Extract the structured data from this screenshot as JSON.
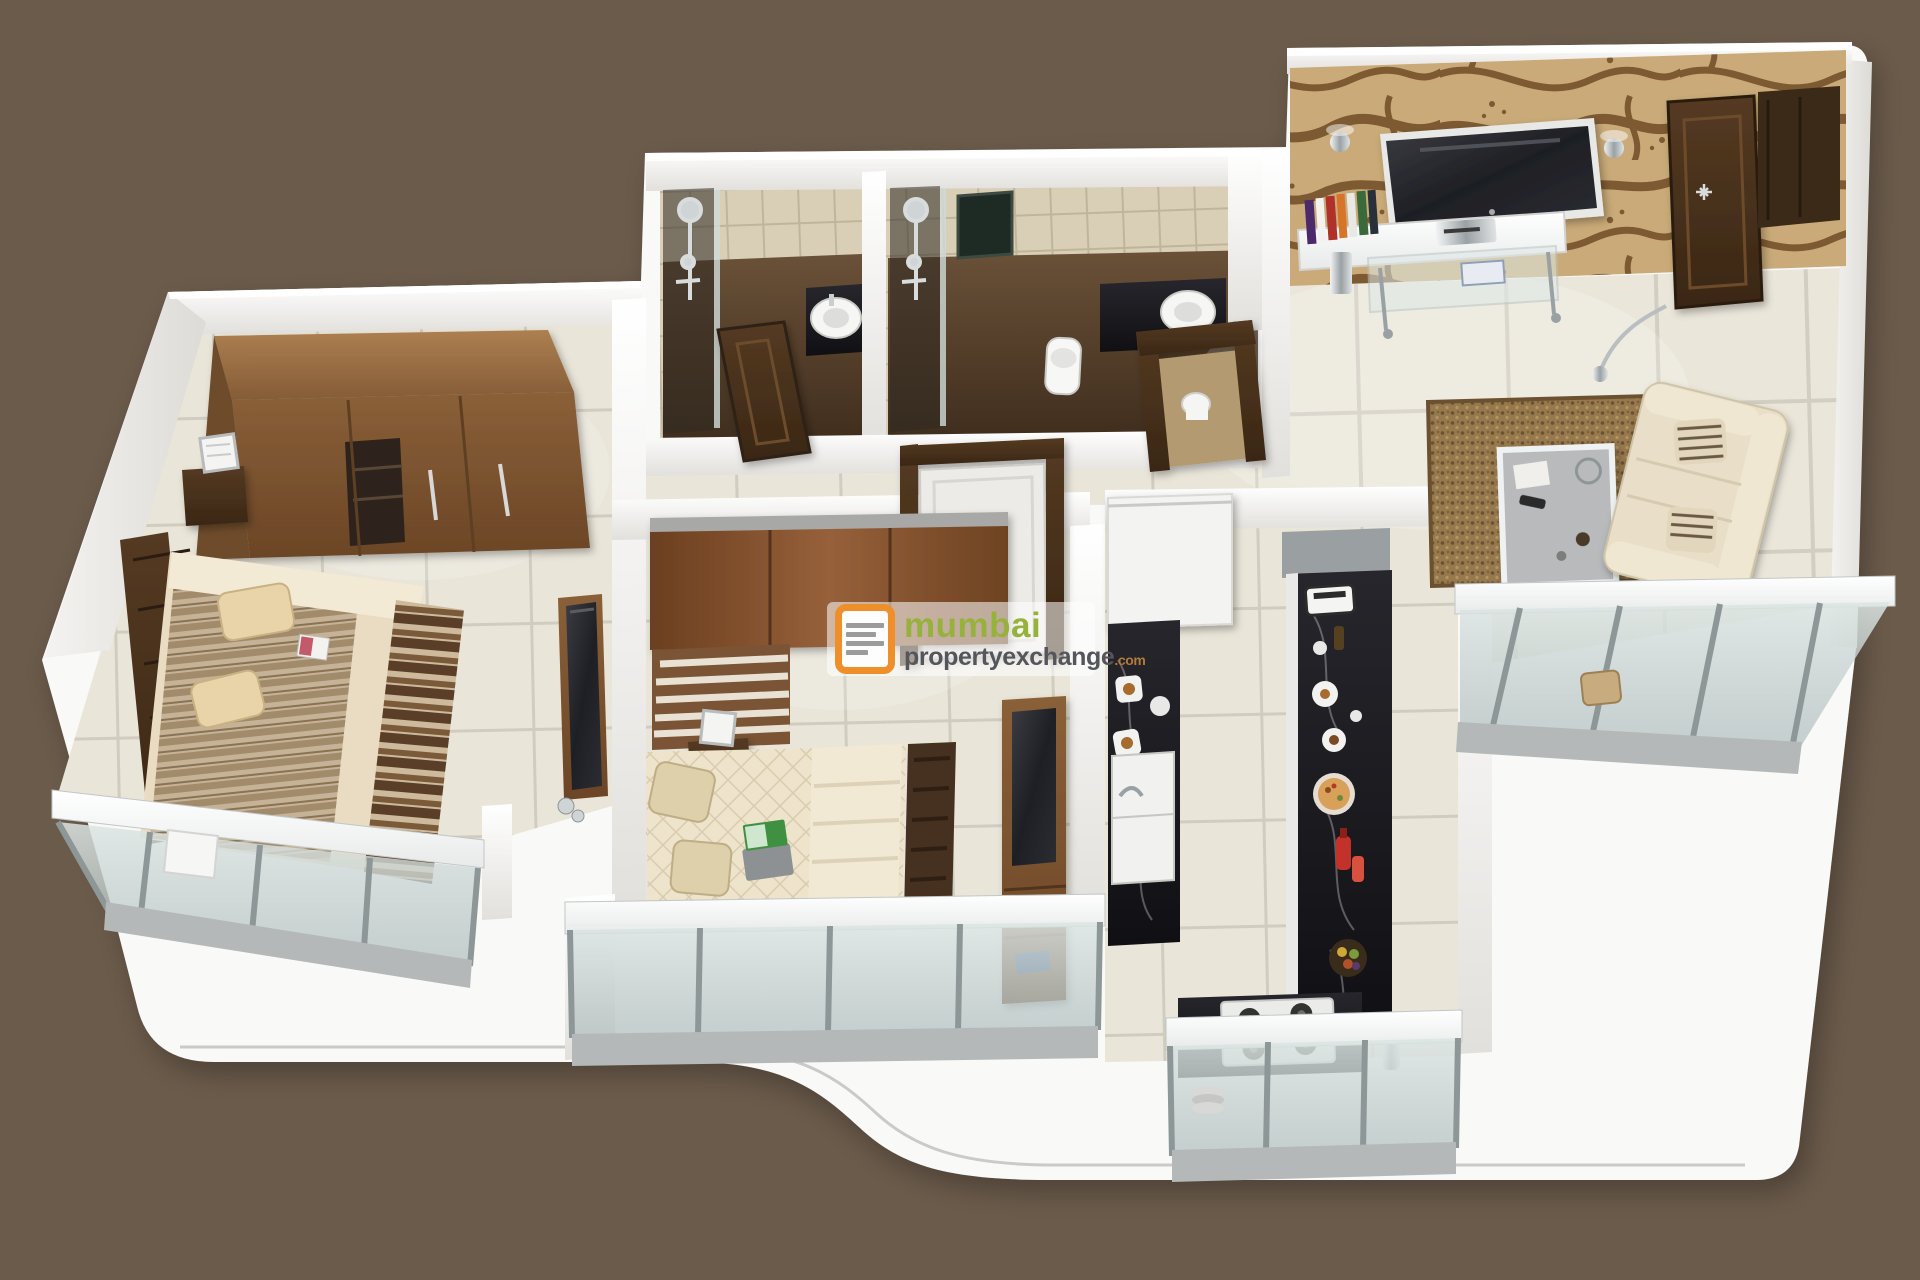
{
  "watermark": {
    "line1": "mumbai",
    "line2": "propertyexchange",
    "suffix": ".com",
    "logo_icon": "property-exchange-logo",
    "panel_color": "rgba(255,255,255,0.55)",
    "line1_color": "#97b23c",
    "line2_color": "#55565b",
    "suffix_color": "#b27a3c",
    "logo_color": "#ee8f2a"
  },
  "scene": {
    "style": "3d-isometric-apartment-floor-plan-render",
    "background_color": "#6b5b4b",
    "platform_color": "#f9f9f8",
    "floor_tile_color": "#e9e5d9",
    "accent_wallpaper": "animal-print",
    "rooms": [
      {
        "name": "master-bedroom",
        "floor": "beige-tiles",
        "furniture": [
          "wardrobe",
          "slatted-headboard",
          "double-bed",
          "striped-blanket",
          "pillows",
          "magazine",
          "nightstand",
          "cage-lamp",
          "wall-tv",
          "bed-foot-runner",
          "chrome-figurine"
        ],
        "balcony": "glass-railing-balcony"
      },
      {
        "name": "bathroom-1",
        "floor": "dark-brown",
        "walls": "beige-tiles",
        "furniture": [
          "shower-set",
          "glass-partition",
          "granite-counter",
          "round-washbasin",
          "toilet",
          "wooden-door"
        ]
      },
      {
        "name": "bathroom-2",
        "floor": "dark-brown",
        "walls": "beige-tiles",
        "furniture": [
          "shower-set",
          "glass-partition",
          "mirror-niche",
          "granite-counter",
          "round-washbasin",
          "toilet",
          "door-frame",
          "toilet-paper-roll"
        ]
      },
      {
        "name": "bedroom-2",
        "floor": "beige-tiles",
        "furniture": [
          "wardrobe",
          "slatted-headboard",
          "nightstand",
          "cage-lamp",
          "double-bed",
          "quilted-mattress",
          "laptop",
          "folded-blanket",
          "shag-runner",
          "tv-cabinet",
          "flat-tv",
          "book",
          "white-door"
        ],
        "balcony": "glass-railing-balcony"
      },
      {
        "name": "kitchen",
        "floor": "beige-tiles",
        "furniture": [
          "refrigerator",
          "sink",
          "black-granite-counters",
          "breakfast-plates",
          "toaster",
          "glassware",
          "pizza-plate",
          "sauce-bottle",
          "fruit-bowl",
          "gas-hob",
          "water-purifier",
          "plate-stack"
        ],
        "balcony": "glass-railing-dry-balcony"
      },
      {
        "name": "living-room",
        "floor": "large-beige-tiles",
        "furniture": [
          "animal-print-accent-wall",
          "wall-sconce-left",
          "wall-sconce-right",
          "wall-tv",
          "media-shelf",
          "book-row",
          "dvd-player",
          "glass-media-rack",
          "chrome-canister",
          "entrance-door",
          "shoe-cabinet",
          "shag-rug",
          "glass-coffee-table",
          "floor-lamp",
          "cream-sofa",
          "striped-cushions",
          "wooden-stool"
        ],
        "balcony": "glass-railing-balcony"
      }
    ],
    "balconies": [
      "master-bedroom-balcony",
      "bedroom-2-balcony",
      "kitchen-dry-balcony",
      "living-room-balcony"
    ],
    "colors": {
      "wood_light": "#a5794c",
      "wood_mid": "#7b5634",
      "wood_dark": "#4c3520",
      "black_granite": "#17181b",
      "glass": "#c6d2d0",
      "sofa_cream": "#e9dfc9",
      "rug_brown": "#97794e",
      "bath_floor": "#5c4530",
      "wallpaper_tan": "#c9aa78",
      "wallpaper_brown": "#7d5a32"
    }
  }
}
